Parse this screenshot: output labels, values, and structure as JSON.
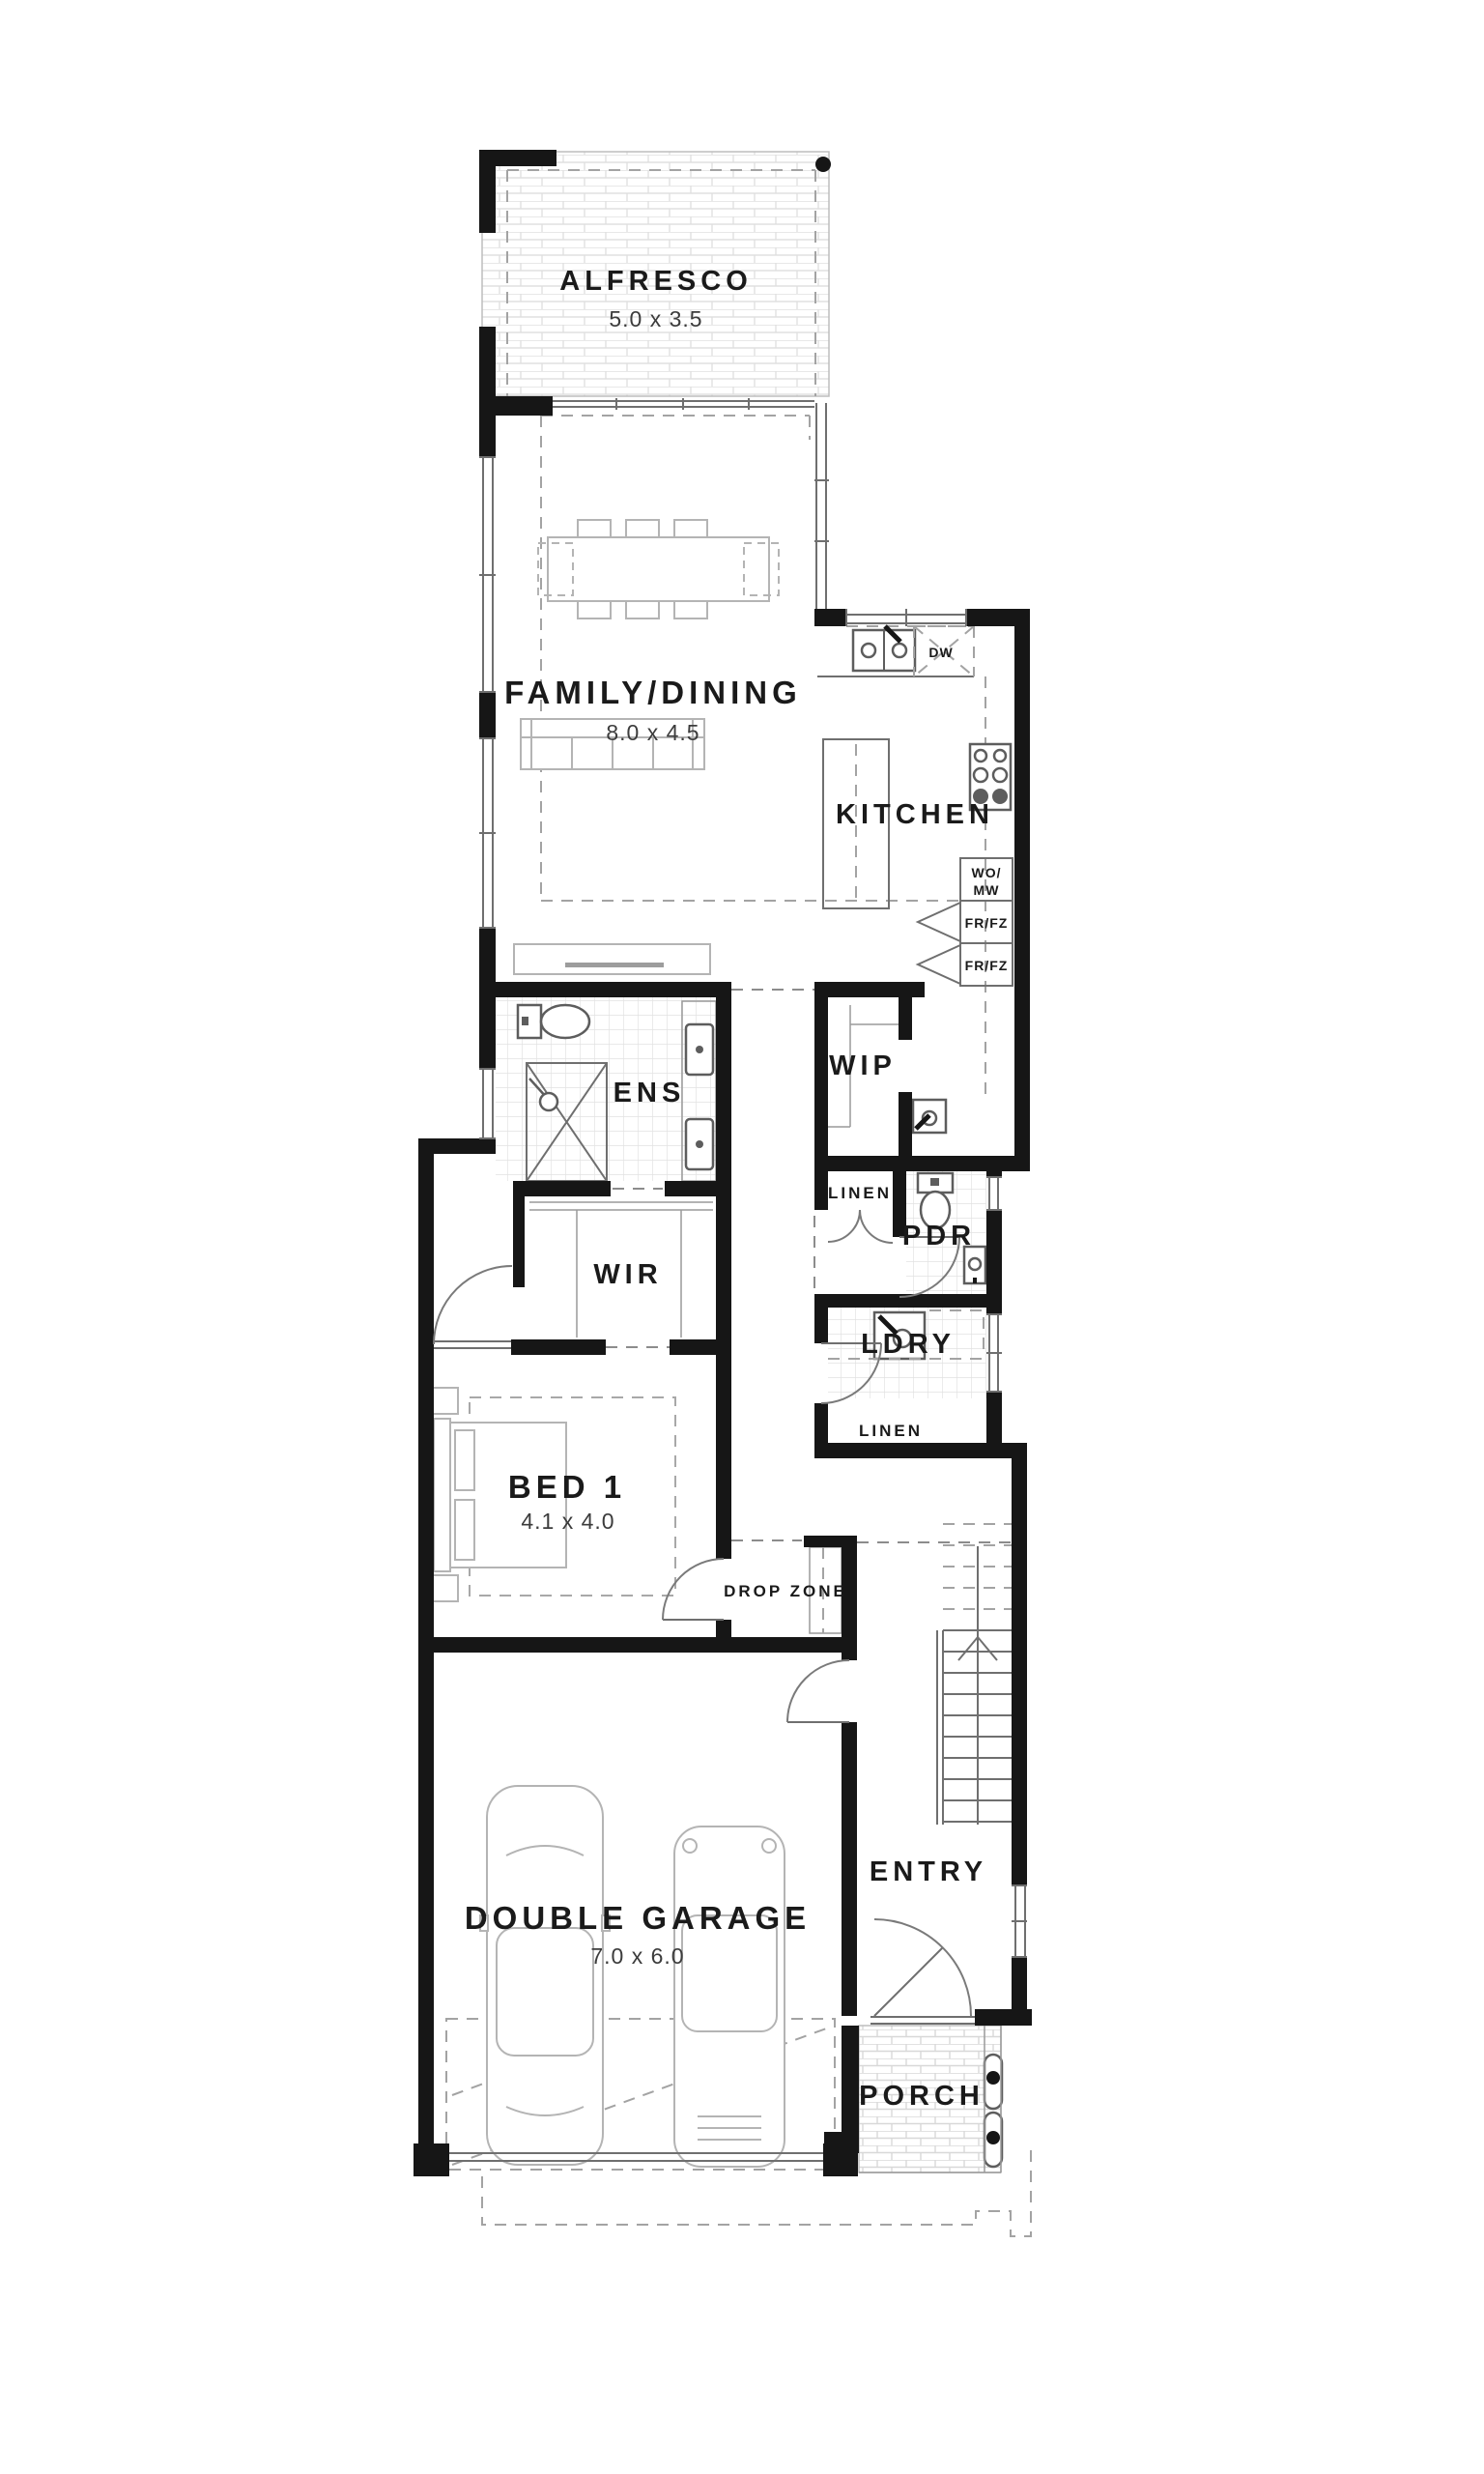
{
  "plan": {
    "rooms": {
      "alfresco": {
        "label": "ALFRESCO",
        "dims": "5.0 x 3.5"
      },
      "family_dining": {
        "label": "FAMILY/DINING",
        "dims": "8.0 x 4.5"
      },
      "kitchen": {
        "label": "KITCHEN"
      },
      "wip": {
        "label": "WIP"
      },
      "ens": {
        "label": "ENS"
      },
      "wir": {
        "label": "WIR"
      },
      "linen_hall": {
        "label": "LINEN"
      },
      "pdr": {
        "label": "PDR"
      },
      "ldry": {
        "label": "LDRY"
      },
      "linen_laundry": {
        "label": "LINEN"
      },
      "bed1": {
        "label": "BED 1",
        "dims": "4.1 x 4.0"
      },
      "drop_zone": {
        "label": "DROP ZONE"
      },
      "garage": {
        "label": "DOUBLE GARAGE",
        "dims": "7.0 x 6.0"
      },
      "entry": {
        "label": "ENTRY"
      },
      "porch": {
        "label": "PORCH"
      }
    },
    "appliances": {
      "dishwasher": "DW",
      "wall_oven_line1": "WO/",
      "wall_oven_line2": "MW",
      "fridge_freezer_1": "FR/FZ",
      "fridge_freezer_2": "FR/FZ"
    },
    "colors": {
      "wall": "#161616",
      "label_text": "#1a1a1a",
      "dim_text": "#3c3c3c",
      "fixture_line": "#5d5d5d",
      "furniture_line": "#b4b4b4",
      "tile_line": "#e2e2e2",
      "dashed_line": "#8c8c8c",
      "background": "#ffffff"
    }
  }
}
